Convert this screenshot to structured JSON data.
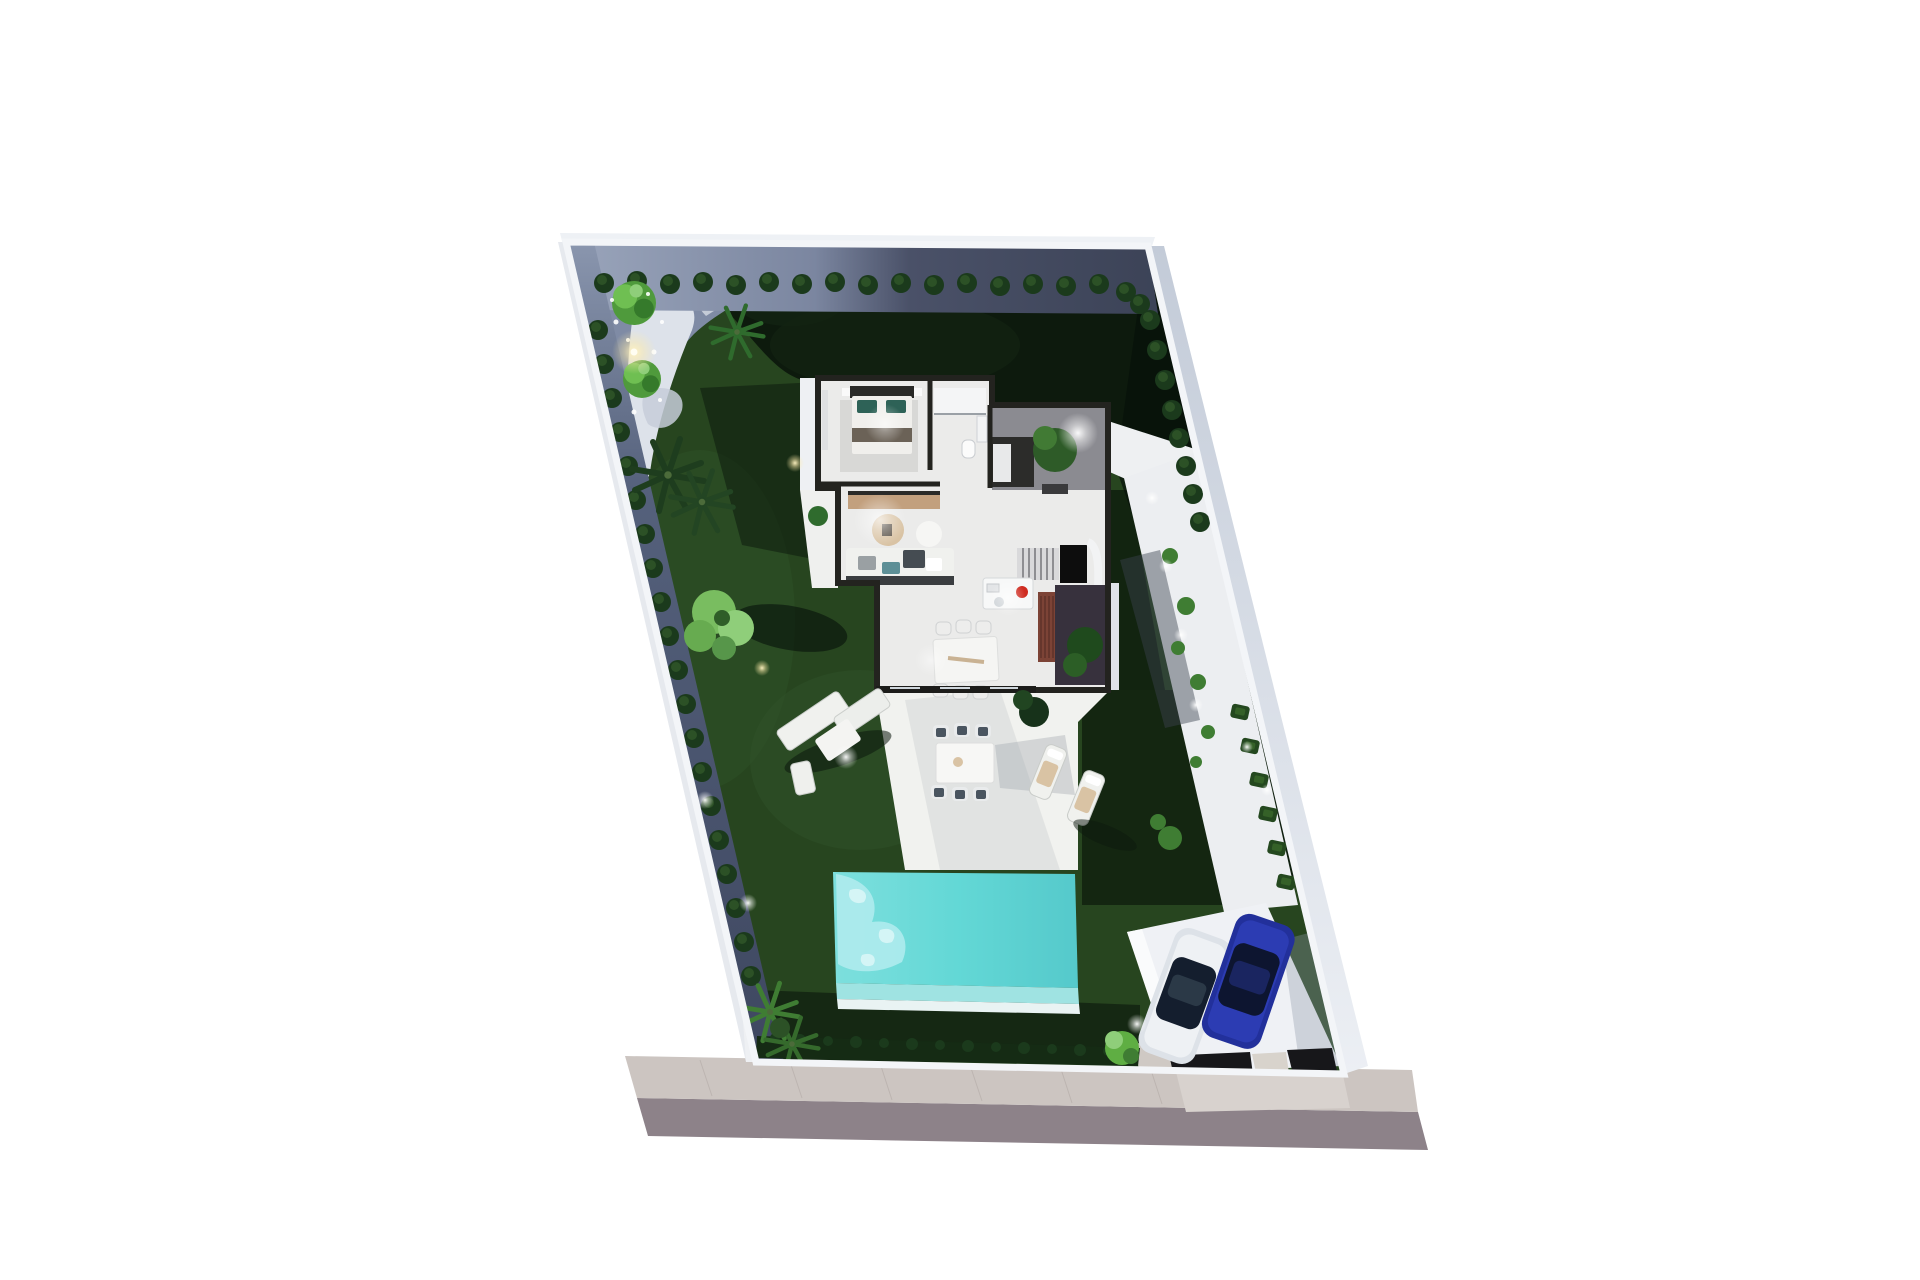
{
  "meta": {
    "image_kind": "3d-architectural-site-plan-render",
    "view": "top-down aerial of villa plot with garden, pool and carport",
    "visible_text": "none"
  },
  "scene": {
    "background": "#ffffff",
    "street": {
      "sidewalk_color": "#ccc5c1",
      "road_color": "#8d8289",
      "driveway_color": "#d8d2ce",
      "paver_line_color": "#b9b1ad"
    },
    "plot": {
      "wall_color": "#f3f5f8",
      "wall_face_right": "#ccd3dd",
      "wall_face_left": "#e6e9ee",
      "grass_base": "#27451f",
      "grass_light": "#3f6a33",
      "grass_shadow": "#07110a",
      "mulch_light": "#8a96ae",
      "mulch_dark": "#3e4760",
      "gravel_light": "#dde2ea"
    },
    "pool": {
      "water": "#63d8d6",
      "water_light": "#b3ecee",
      "step": "#9fe3e2",
      "coping": "#e9f3f3"
    },
    "house": {
      "wall_dark": "#23231f",
      "floor": "#ebebea",
      "porch_floor": "#8b8b91",
      "courtyard_floor": "#37313d",
      "deck_wood": "#7c4336",
      "tv_console_wood": "#c2a07e",
      "kitchen_hotspot_red": "#cf2b20",
      "stair_tread": "#d9d9db",
      "rug": "#d8d8d6"
    },
    "furniture": {
      "white": "#f0f1ee",
      "cushion_teal": "#5d8f96",
      "cushion_dark": "#454c52",
      "bed_pillow_teal": "#2e6257",
      "towel_tan": "#d9c3a4"
    },
    "vegetation": {
      "bush_dark": "#1b3a1c",
      "bush_mid": "#2c5126",
      "tree_green": "#4f9a3c",
      "tree_light": "#8fce7a",
      "palm_dark": "#1e3d1e",
      "palm_green": "#2f6b2d",
      "hedge_dark": "#152b14"
    },
    "carport": {
      "slab": "#eff1f5",
      "strip_dark": "#17171a",
      "car_white_body": "#dde2e8",
      "car_blue_body": "#22309b",
      "car_glass_dark": "#141e2e"
    },
    "lighting": {
      "glow_warm": "#fff3c4",
      "glow_white": "#ffffff"
    }
  },
  "objects": {
    "garden": [
      "lawn",
      "perimeter-bush-hedges",
      "garden-trees",
      "palm-trees",
      "garden-lamp",
      "gravel-corner-path"
    ],
    "house_rooms": [
      "bedroom",
      "bathroom",
      "entry-porch",
      "living-room",
      "kitchen-island",
      "indoor-dining",
      "staircase",
      "courtyard-patio"
    ],
    "outdoor": [
      "terrace",
      "swimming-pool",
      "outdoor-sofa-set",
      "outdoor-dining-set",
      "sun-loungers",
      "side-walkway"
    ],
    "parking": [
      "carport-slab",
      "white-car",
      "blue-car",
      "driveway"
    ],
    "street": [
      "sidewalk",
      "road"
    ],
    "counts": {
      "cars": 2,
      "sun_loungers": 2,
      "outdoor_dining_chairs": 6,
      "indoor_dining_chairs": 6
    }
  }
}
